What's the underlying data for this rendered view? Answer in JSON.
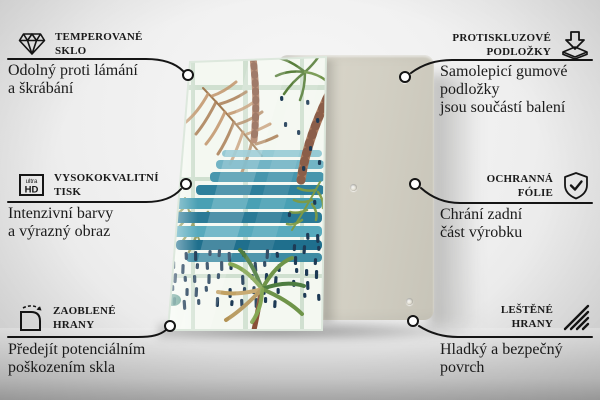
{
  "page": {
    "kind": "product feature infographic",
    "accent_color": "#151515"
  },
  "product": {
    "front_board": "glass-board-tropical-watercolor-print",
    "back_board": "plain-back-board-with-pad-holes",
    "colors": {
      "back_board": "#d2cfc3",
      "print_background": "#f4f8f1",
      "stripe_teal": "#2e7f9b",
      "dash_navy": "#1d3a55",
      "leaf_tan": "#b58a61",
      "leaf_green": "#5f8440",
      "trunk_brown": "#ab7a5e"
    }
  },
  "features": {
    "left": [
      {
        "icon": "diamond-icon",
        "title_lines": [
          "TEMPEROVANÉ",
          "SKLO"
        ],
        "desc_lines": [
          "Odolný proti lámání",
          "a škrábání"
        ]
      },
      {
        "icon": "ultra-hd-icon",
        "icon_text": {
          "small": "ultra",
          "big": "HD"
        },
        "title_lines": [
          "VYSOKOKVALITNÍ",
          "TISK"
        ],
        "desc_lines": [
          "Intenzivní barvy",
          "a výrazný obraz"
        ]
      },
      {
        "icon": "rounded-corner-icon",
        "title_lines": [
          "ZAOBLENÉ",
          "HRANY"
        ],
        "desc_lines": [
          "Předejít potenciálním",
          "poškozením skla"
        ]
      }
    ],
    "right": [
      {
        "icon": "anti-slip-pads-icon",
        "title_lines": [
          "PROTISKLUZOVÉ",
          "PODLOŽKY"
        ],
        "desc_lines": [
          "Samolepicí gumové podložky",
          "jsou součástí balení"
        ]
      },
      {
        "icon": "shield-check-icon",
        "title_lines": [
          "OCHRANNÁ",
          "FÓLIE"
        ],
        "desc_lines": [
          "Chrání zadní",
          "část výrobku"
        ]
      },
      {
        "icon": "polished-edges-icon",
        "title_lines": [
          "LEŠTĚNÉ",
          "HRANY"
        ],
        "desc_lines": [
          "Hladký a bezpečný povrch"
        ]
      }
    ]
  }
}
